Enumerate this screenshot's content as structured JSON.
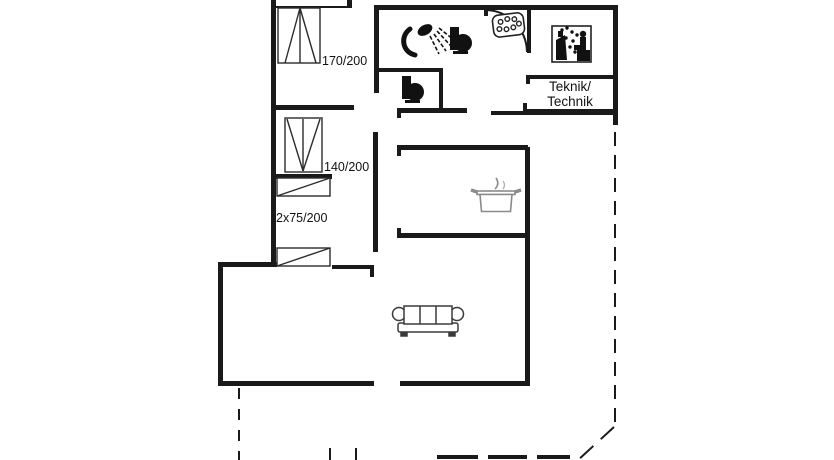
{
  "floorplan": {
    "labels": {
      "bed_double_size": "170/200",
      "bed_140_size": "140/200",
      "bunk_beds_size": "2x75/200",
      "technical_room_line1": "Teknik/",
      "technical_room_line2": "Technik"
    },
    "icons": {
      "shower": "shower-icon",
      "bathroom_toilet": "toilet-icon",
      "guest_toilet": "toilet-icon",
      "whirlpool": "whirlpool-bubbles-icon",
      "sauna": "sauna-icon",
      "cooking_pot": "cooking-pot-icon",
      "sofa": "sofa-icon",
      "double_bed": "double-bed-icon",
      "bunk_bed": "bunk-bed-icon",
      "entrance_door": "door-swing-arc"
    },
    "colors": {
      "background": "#ffffff",
      "wall": "#1a1a1a",
      "furniture_outline": "#2b2b2b",
      "pot_outline": "#8a8a8a"
    }
  }
}
